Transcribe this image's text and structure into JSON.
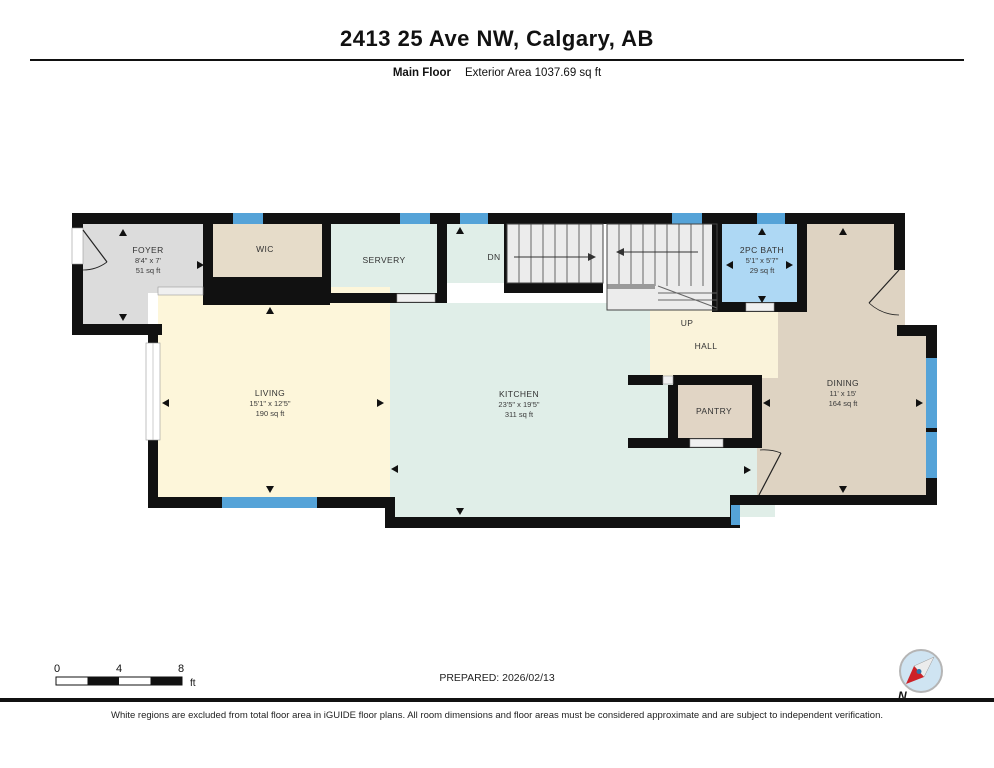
{
  "header": {
    "title": "2413 25 Ave NW, Calgary, AB",
    "floor_label": "Main Floor",
    "area_label": "Exterior Area 1037.69 sq ft"
  },
  "rooms": {
    "foyer": {
      "name": "FOYER",
      "dims": "8'4\" x 7'",
      "area": "51 sq ft"
    },
    "wic": {
      "name": "WIC"
    },
    "servery": {
      "name": "SERVERY"
    },
    "stairs": {
      "down_label": "DN",
      "up_label": "UP"
    },
    "bath": {
      "name": "2PC BATH",
      "dims": "5'1\" x 5'7\"",
      "area": "29 sq ft"
    },
    "hall": {
      "name": "HALL"
    },
    "living": {
      "name": "LIVING",
      "dims": "15'1\" x 12'5\"",
      "area": "190 sq ft"
    },
    "kitchen": {
      "name": "KITCHEN",
      "dims": "23'5\" x 19'5\"",
      "area": "311 sq ft"
    },
    "pantry": {
      "name": "PANTRY"
    },
    "dining": {
      "name": "DINING",
      "dims": "11' x 15'",
      "area": "164 sq ft"
    }
  },
  "footer": {
    "scale": {
      "tick0": "0",
      "tick4": "4",
      "tick8": "8",
      "unit": "ft"
    },
    "prepared": "PREPARED: 2026/02/13",
    "compass_label": "N"
  },
  "disclaimer": "White regions are excluded from total floor area in iGUIDE floor plans. All room dimensions and floor areas must be considered approximate and are subject to independent verification.",
  "colors": {
    "wall": "#111111",
    "window": "#55a3d8",
    "foyer": "#dcdcdc",
    "wic": "#e6dcc9",
    "servery": "#e0eee8",
    "kitchen": "#e0eee8",
    "living": "#fdf6da",
    "hall": "#faf3da",
    "dining": "#ded3c2",
    "pantry": "#e1d5c5",
    "bath": "#aed8f4",
    "stairs": "#ececec",
    "opening": "#f0f0f0",
    "compass_face": "#cfe4f2",
    "compass_red": "#cc2127"
  }
}
